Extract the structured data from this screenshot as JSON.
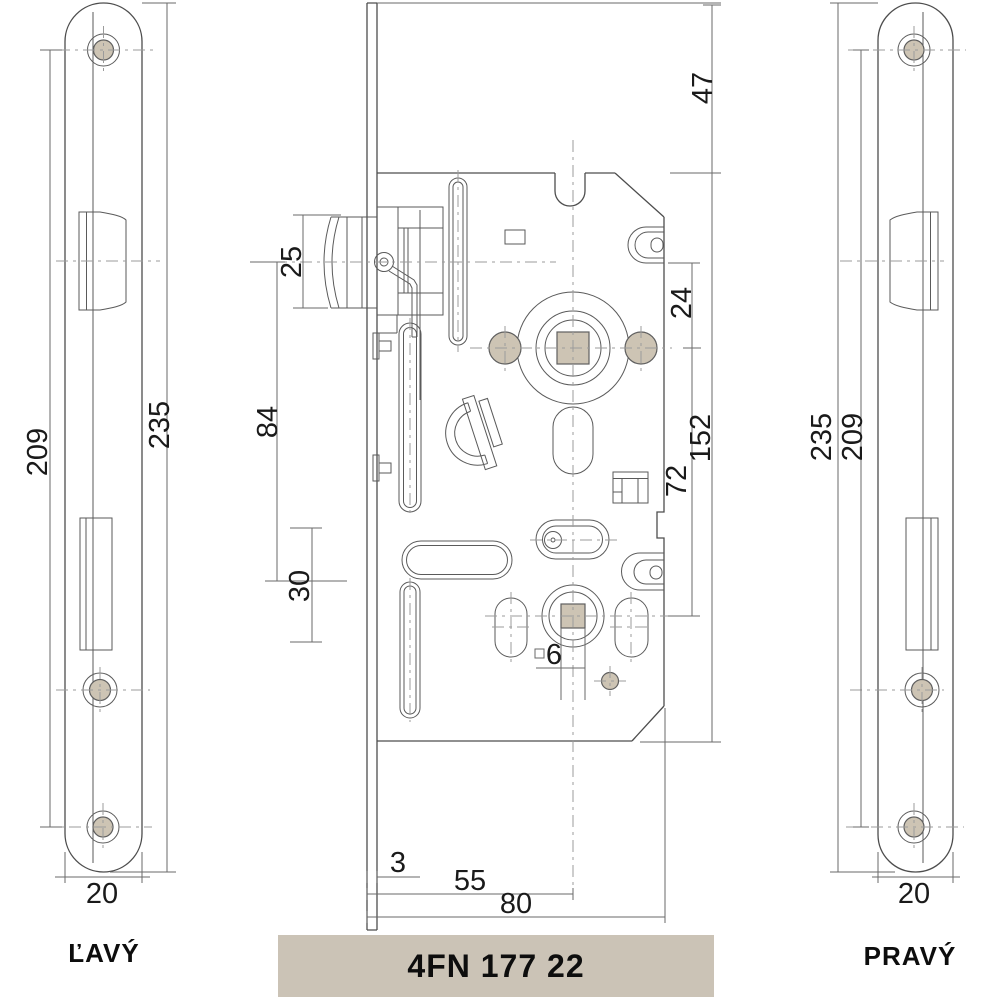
{
  "product": {
    "code": "4FN 177 22"
  },
  "left_plate": {
    "label": "ĽAVÝ",
    "dim_screw_distance": "209",
    "dim_total_height": "235",
    "dim_width": "20"
  },
  "right_plate": {
    "label": "PRAVÝ",
    "dim_total_height": "235",
    "dim_screw_distance": "209",
    "dim_width": "20"
  },
  "lock_case": {
    "dim_latch_height": "25",
    "dim_latch_to_bolt": "84",
    "dim_bolt_height": "30",
    "dim_top_to_case": "47",
    "dim_hub_offset": "24",
    "dim_case_height": "152",
    "dim_hub_distance": "72",
    "dim_spindle_square": "6",
    "dim_faceplate_thickness": "3",
    "dim_backset": "55",
    "dim_case_depth": "80"
  },
  "colors": {
    "accent": "#cdc4b4",
    "badge_bg": "#cbc3b6",
    "line": "#4d4d4d"
  }
}
